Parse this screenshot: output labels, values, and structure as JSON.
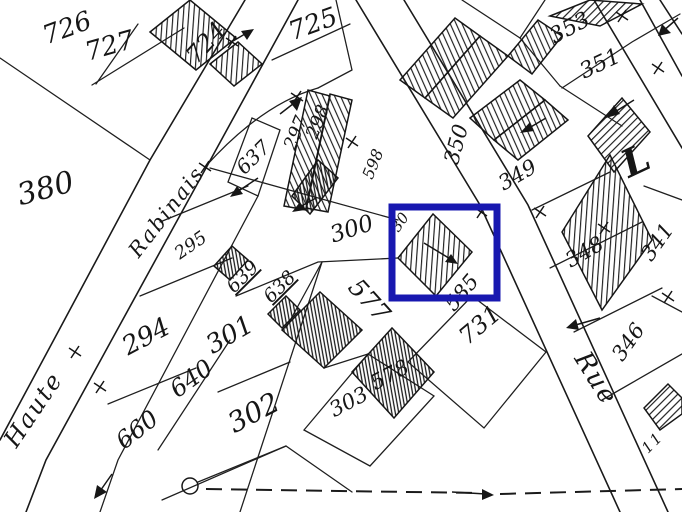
{
  "map": {
    "kind": "scanned cadastral plan",
    "paper_color": "#ffffff",
    "ink_color": "#1b1b1b",
    "highlight": {
      "name": "selection-rectangle",
      "color": "#1d1dae",
      "x": 392,
      "y": 207,
      "width": 105,
      "height": 91,
      "stroke_width": 7
    },
    "street_labels": [
      {
        "text": "Rabinais",
        "x": 172,
        "y": 216,
        "r": -52,
        "s": 21
      },
      {
        "text": "Haute",
        "x": 40,
        "y": 414,
        "r": -56,
        "s": 24
      },
      {
        "text": "Rue",
        "x": 589,
        "y": 383,
        "r": 58,
        "s": 26
      },
      {
        "text": "L",
        "x": 642,
        "y": 172,
        "r": -25,
        "s": 38,
        "w": "bold"
      },
      {
        "text": "11",
        "x": 656,
        "y": 446,
        "r": -45,
        "s": 15
      }
    ],
    "parcel_labels": [
      {
        "text": "726",
        "x": 70,
        "y": 36,
        "r": -20,
        "s": 26
      },
      {
        "text": "727",
        "x": 112,
        "y": 54,
        "r": -16,
        "s": 26
      },
      {
        "text": "724",
        "x": 212,
        "y": 48,
        "r": -48,
        "s": 24
      },
      {
        "text": "725",
        "x": 316,
        "y": 32,
        "r": -20,
        "s": 26
      },
      {
        "text": "353",
        "x": 573,
        "y": 34,
        "r": -28,
        "s": 22
      },
      {
        "text": "351",
        "x": 603,
        "y": 70,
        "r": -25,
        "s": 22
      },
      {
        "text": "380",
        "x": 48,
        "y": 198,
        "r": -15,
        "s": 30
      },
      {
        "text": "295",
        "x": 194,
        "y": 250,
        "r": -35,
        "s": 18
      },
      {
        "text": "637",
        "x": 258,
        "y": 162,
        "r": -45,
        "s": 20
      },
      {
        "text": "297",
        "x": 301,
        "y": 135,
        "r": -68,
        "s": 18
      },
      {
        "text": "298",
        "x": 323,
        "y": 124,
        "r": -68,
        "s": 18
      },
      {
        "text": "598",
        "x": 378,
        "y": 166,
        "r": -68,
        "s": 16
      },
      {
        "text": "350",
        "x": 463,
        "y": 146,
        "r": -75,
        "s": 21
      },
      {
        "text": "349",
        "x": 521,
        "y": 181,
        "r": -30,
        "s": 21
      },
      {
        "text": "348",
        "x": 588,
        "y": 258,
        "r": -30,
        "s": 21
      },
      {
        "text": "341",
        "x": 663,
        "y": 246,
        "r": -55,
        "s": 21
      },
      {
        "text": "346",
        "x": 634,
        "y": 346,
        "r": -55,
        "s": 21
      },
      {
        "text": "300",
        "x": 354,
        "y": 236,
        "r": -18,
        "s": 23
      },
      {
        "text": "639",
        "x": 247,
        "y": 281,
        "r": -45,
        "s": 19,
        "underline": true
      },
      {
        "text": "638",
        "x": 284,
        "y": 291,
        "r": -45,
        "s": 19,
        "underline": true
      },
      {
        "text": "294",
        "x": 150,
        "y": 344,
        "r": -28,
        "s": 26
      },
      {
        "text": "301",
        "x": 234,
        "y": 342,
        "r": -30,
        "s": 26
      },
      {
        "text": "640",
        "x": 196,
        "y": 385,
        "r": -36,
        "s": 24
      },
      {
        "text": "302",
        "x": 258,
        "y": 421,
        "r": -28,
        "s": 28
      },
      {
        "text": "660",
        "x": 142,
        "y": 436,
        "r": -38,
        "s": 24
      },
      {
        "text": "303",
        "x": 352,
        "y": 408,
        "r": -28,
        "s": 21
      },
      {
        "text": "578",
        "x": 393,
        "y": 381,
        "r": -28,
        "s": 21
      },
      {
        "text": "731",
        "x": 485,
        "y": 331,
        "r": -40,
        "s": 24
      },
      {
        "text": "585",
        "x": 467,
        "y": 297,
        "r": -50,
        "s": 21
      },
      {
        "text": "577",
        "x": 363,
        "y": 306,
        "r": 48,
        "s": 25
      },
      {
        "text": "30",
        "x": 404,
        "y": 225,
        "r": -55,
        "s": 15
      }
    ]
  }
}
